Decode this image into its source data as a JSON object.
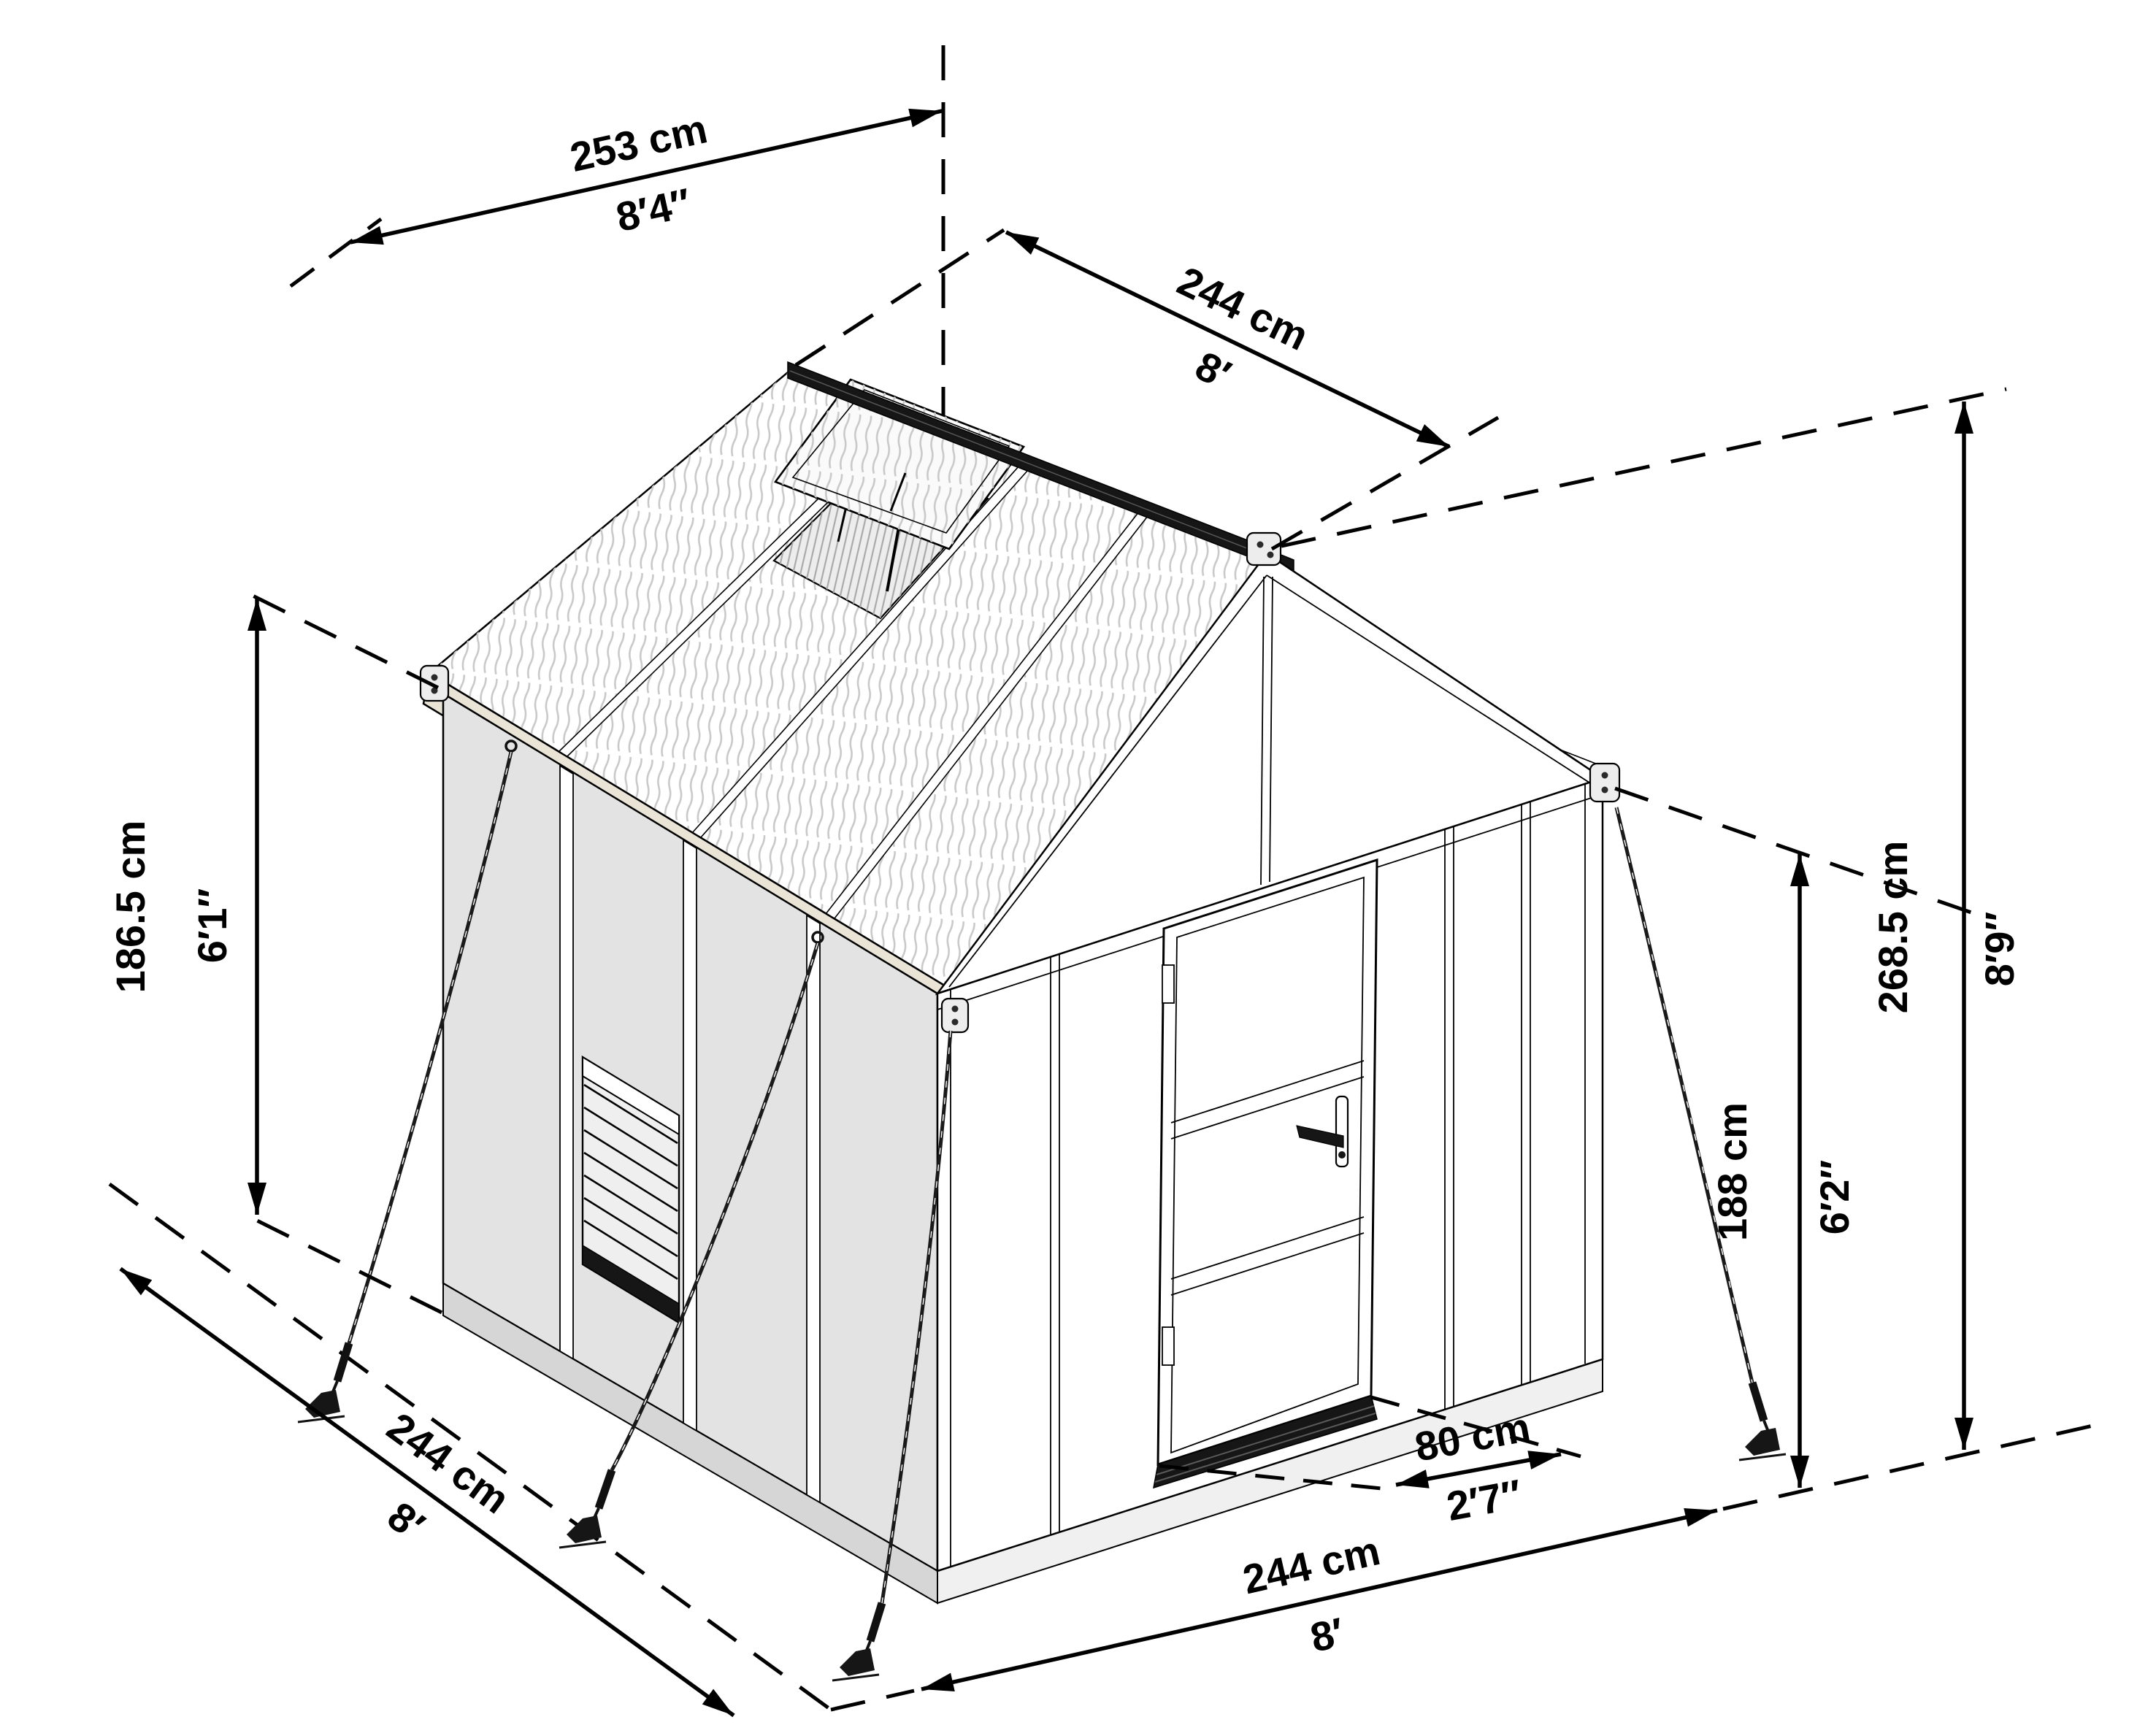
{
  "title": "Greenhouse dimensions diagram",
  "dimensions": {
    "roof_panel_width": {
      "metric": "253 cm",
      "imperial": "8′4″"
    },
    "roof_depth": {
      "metric": "244 cm",
      "imperial": "8′"
    },
    "ridge_height": {
      "metric": "268.5 cm",
      "imperial": "8′9″"
    },
    "wall_height": {
      "metric": "188 cm",
      "imperial": "6′2″"
    },
    "eave_height": {
      "metric": "186.5 cm",
      "imperial": "6′1″"
    },
    "floor_depth": {
      "metric": "244 cm",
      "imperial": "8′"
    },
    "door_width": {
      "metric": "80 cm",
      "imperial": "2′7″"
    },
    "floor_width": {
      "metric": "244 cm",
      "imperial": "8′"
    }
  },
  "colors": {
    "line": "#000000",
    "side_panel": "#e3e3e3",
    "eave_beam": "#eae4d6",
    "dark_detail": "#161616",
    "roof_stripe": "#c9c9c9",
    "foundation": "#d6d6d6"
  }
}
